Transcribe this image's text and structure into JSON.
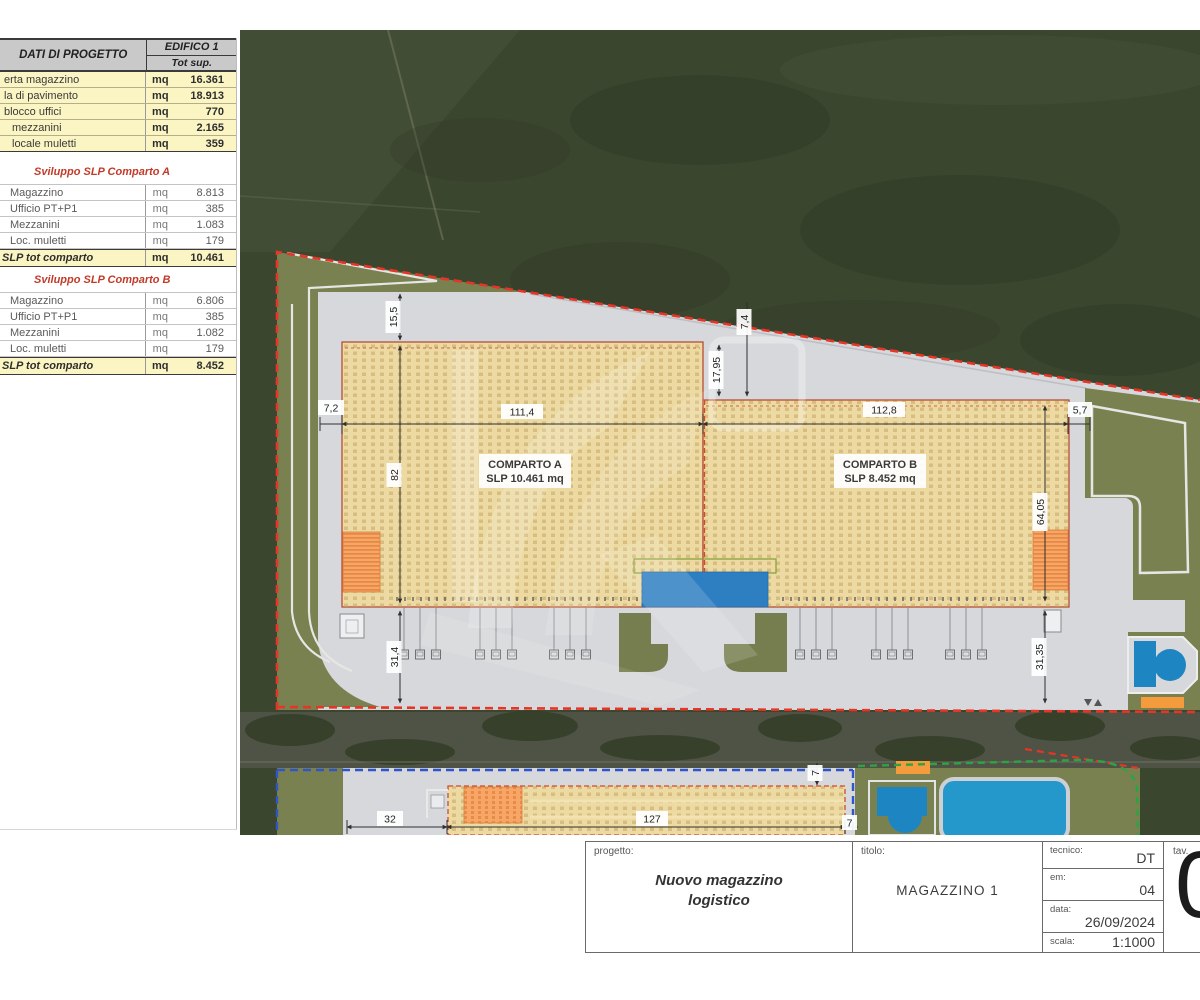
{
  "panel": {
    "header": {
      "title": "DATI DI PROGETTO",
      "building": "EDIFICO 1",
      "subtitle": "Tot sup."
    },
    "edificio_rows": [
      {
        "label": "erta magazzino",
        "unit": "mq",
        "value": "16.361"
      },
      {
        "label": "la di pavimento",
        "unit": "mq",
        "value": "18.913"
      },
      {
        "label": "blocco uffici",
        "unit": "mq",
        "value": "770"
      },
      {
        "label": "mezzanini",
        "unit": "mq",
        "value": "2.165"
      },
      {
        "label": "locale muletti",
        "unit": "mq",
        "value": "359"
      }
    ],
    "sections": [
      {
        "title": "Sviluppo SLP Comparto A",
        "rows": [
          {
            "label": "Magazzino",
            "unit": "mq",
            "value": "8.813"
          },
          {
            "label": "Ufficio PT+P1",
            "unit": "mq",
            "value": "385"
          },
          {
            "label": "Mezzanini",
            "unit": "mq",
            "value": "1.083"
          },
          {
            "label": "Loc. muletti",
            "unit": "mq",
            "value": "179"
          }
        ],
        "total": {
          "label": "SLP tot comparto",
          "unit": "mq",
          "value": "10.461"
        }
      },
      {
        "title": "Sviluppo SLP Comparto B",
        "rows": [
          {
            "label": "Magazzino",
            "unit": "mq",
            "value": "6.806"
          },
          {
            "label": "Ufficio PT+P1",
            "unit": "mq",
            "value": "385"
          },
          {
            "label": "Mezzanini",
            "unit": "mq",
            "value": "1.082"
          },
          {
            "label": "Loc. muletti",
            "unit": "mq",
            "value": "179"
          }
        ],
        "total": {
          "label": "SLP tot comparto",
          "unit": "mq",
          "value": "8.452"
        }
      }
    ]
  },
  "plan": {
    "comparto_a": {
      "line1": "COMPARTO A",
      "line2": "SLP 10.461 mq"
    },
    "comparto_b": {
      "line1": "COMPARTO B",
      "line2": "SLP 8.452 mq"
    },
    "dims": {
      "d15_5": "15,5",
      "d7_4": "7,4",
      "d17_95": "17,95",
      "d7_2": "7,2",
      "d111_4": "111,4",
      "d112_8": "112,8",
      "d5_7": "5,7",
      "d82": "82",
      "d64_05": "64,05",
      "d31_4": "31,4",
      "d31_35": "31,35",
      "d32": "32",
      "d127": "127",
      "d7a": "7",
      "d7b": "7"
    }
  },
  "titleblock": {
    "progetto_label": "progetto:",
    "progetto": "Nuovo magazzino logistico",
    "titolo_label": "titolo:",
    "titolo": "MAGAZZINO 1",
    "tecnico_label": "tecnico:",
    "tecnico": "DT",
    "em_label": "em:",
    "em": "04",
    "data_label": "data:",
    "data": "26/09/2024",
    "scala_label": "scala:",
    "scala": "1:1000",
    "tav_label": "tav.",
    "tav": "0"
  },
  "colors": {
    "boundary_red": "#e63426",
    "boundary_blue": "#2f55cb",
    "boundary_green": "#2ea344",
    "building_fill": "#ecdaa2",
    "highlight_orange": "#f7a667",
    "office_blue": "#2e7fc1",
    "water_blue": "#1e85c3",
    "table_yellow": "#fbf5c4",
    "section_red": "#c23a28",
    "site_grey": "#d6d8db",
    "green_olive": "#7a8150",
    "field_dark": "#3b462f"
  }
}
